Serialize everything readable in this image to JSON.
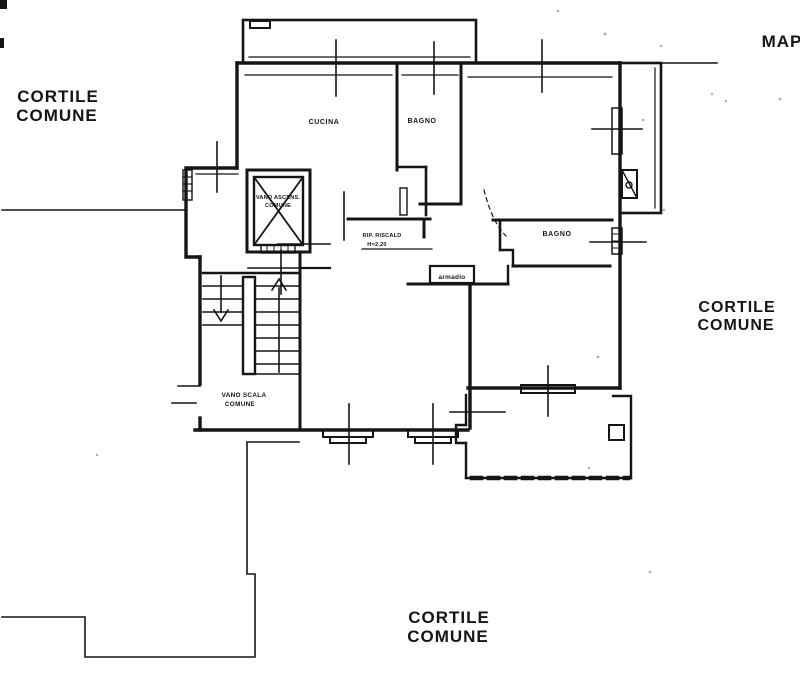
{
  "page": {
    "background": "#ffffff",
    "ink": "#151515",
    "type": "scanned cadastral floor plan"
  },
  "labels": {
    "courtyard_top_left": {
      "line1": "CORTILE",
      "line2": "COMUNE"
    },
    "courtyard_right": {
      "line1": "CORTILE",
      "line2": "COMUNE"
    },
    "courtyard_bottom": {
      "line1": "CORTILE",
      "line2": "COMUNE"
    },
    "map_label": "MAP",
    "kitchen": "CUCINA",
    "bathroom_top": "BAGNO",
    "bathroom_right": "BAGNO",
    "elevator": {
      "line1": "VANO ASCENS.",
      "line2": "COMUNE"
    },
    "heater_closet": {
      "line1": "RIP. RISCALD",
      "line2": "H=2,20"
    },
    "wardrobe": "armadio",
    "stairwell": {
      "line1": "VANO SCALA",
      "line2": "COMUNE"
    }
  }
}
